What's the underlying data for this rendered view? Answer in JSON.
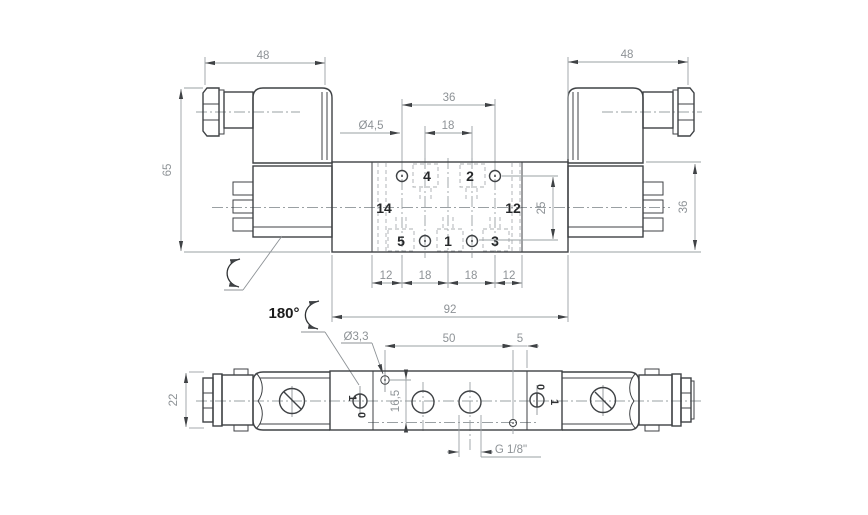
{
  "colors": {
    "background": "#ffffff",
    "outline": "#3f4245",
    "dimension_line": "#9aa0a3",
    "hidden_line": "#abafb2",
    "dimension_text": "#8d9296",
    "dark_text": "#1b1b1b"
  },
  "top_view": {
    "dims": {
      "w48l": "48",
      "w48r": "48",
      "h65": "65",
      "sol36": "36",
      "span36": "36",
      "pitch18": "18",
      "dia45": "Ø4,5",
      "row25": "25",
      "len92": "92",
      "c12a": "12",
      "c18a": "18",
      "c18b": "18",
      "c12b": "12"
    },
    "ports": {
      "p4": "4",
      "p2": "2",
      "p14": "14",
      "p12": "12",
      "p5": "5",
      "p1": "1",
      "p3": "3"
    },
    "rotation": "180°"
  },
  "bottom_view": {
    "dims": {
      "h22": "22",
      "dia33": "Ø3,3",
      "span50": "50",
      "off5": "5",
      "d165": "16,5",
      "thread": "G 1/8\""
    },
    "override": {
      "l1": "1",
      "l0": "0",
      "r0": "0",
      "r1": "1"
    }
  }
}
